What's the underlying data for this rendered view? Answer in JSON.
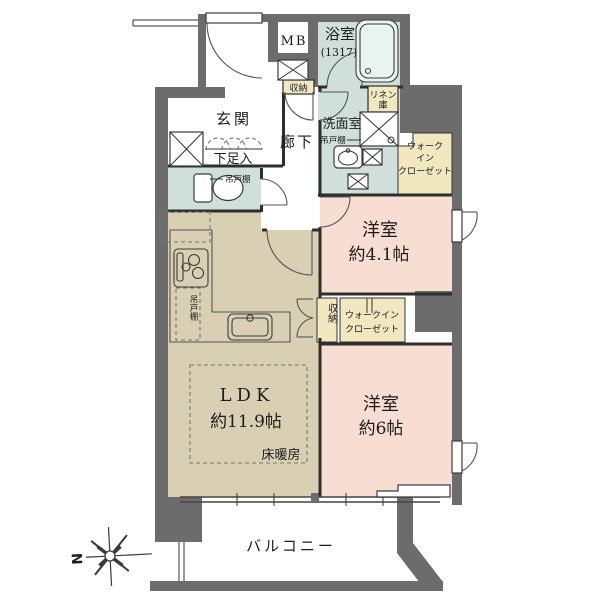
{
  "plan": {
    "type": "apartment-floor-plan",
    "compass": {
      "north": "N"
    },
    "rooms": {
      "mb": {
        "label": "MB"
      },
      "bath": {
        "label": "浴室",
        "size": "(1317)"
      },
      "entrance": {
        "label": "玄関",
        "shoe": "下足入"
      },
      "hallway": {
        "label": "廊下"
      },
      "hall_storage": {
        "label": "収納"
      },
      "washroom": {
        "label": "洗面室",
        "cupboard": "吊戸棚"
      },
      "linen": {
        "line1": "リネン",
        "line2": "庫"
      },
      "wic_right": {
        "line1": "ウォーク",
        "line2": "イン",
        "line3": "クローゼット"
      },
      "bedroom1": {
        "label": "洋室",
        "size": "約4.1帖"
      },
      "storage_mid": {
        "label": "収納"
      },
      "wic_mid": {
        "line1": "ウォークイン",
        "line2": "クローゼット"
      },
      "toilet": {
        "cupboard": "吊戸棚"
      },
      "kitchen": {
        "cupboard": "吊戸棚"
      },
      "ldk": {
        "label": "LDK",
        "size": "約11.9帖",
        "floor_heating": "床暖房"
      },
      "bedroom2": {
        "label": "洋室",
        "size": "約6帖"
      },
      "balcony": {
        "label": "バルコニー"
      }
    },
    "colors": {
      "wall": "#6c6c6c",
      "wet_area": "#cfe0da",
      "closet": "#f1e8c0",
      "bedroom": "#f8ddd3",
      "ldk": "#d9d0b3"
    }
  }
}
